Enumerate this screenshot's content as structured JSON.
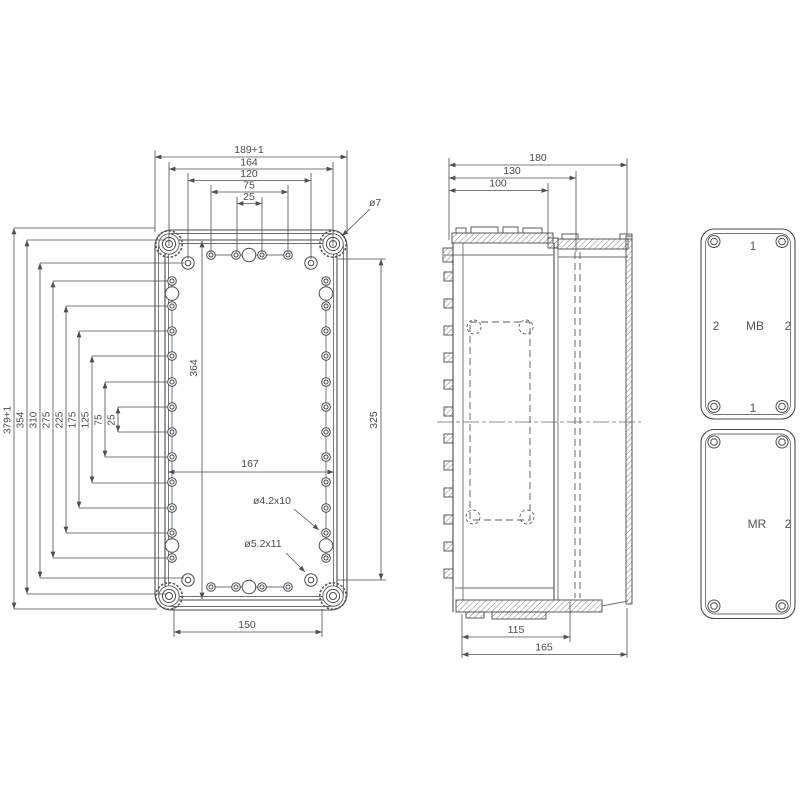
{
  "drawing": {
    "front_view": {
      "top_dims": [
        "189+1",
        "164",
        "120",
        "75",
        "25"
      ],
      "left_dims": [
        "379+1",
        "354",
        "310",
        "275",
        "225",
        "175",
        "125",
        "75",
        "25"
      ],
      "inner_height_dim": "364",
      "right_height_dim": "325",
      "inner_width_dim": "167",
      "bottom_dim": "150",
      "corner_hole_callout": "ø7",
      "small_hole_callout": "ø4.2x10",
      "large_hole_callout": "ø5.2x11"
    },
    "side_view": {
      "top_dims": [
        "180",
        "130",
        "100"
      ],
      "bottom_dims": [
        "115",
        "165"
      ]
    },
    "panels": {
      "mb_panel": {
        "top": "1",
        "left": "2",
        "center": "MB",
        "right": "2",
        "bottom": "1"
      },
      "mr_panel": {
        "center": "MR",
        "right": "2"
      }
    },
    "colors": {
      "line": "#4b4b4b",
      "light_line": "#98a0b4",
      "background": "#ffffff"
    }
  }
}
